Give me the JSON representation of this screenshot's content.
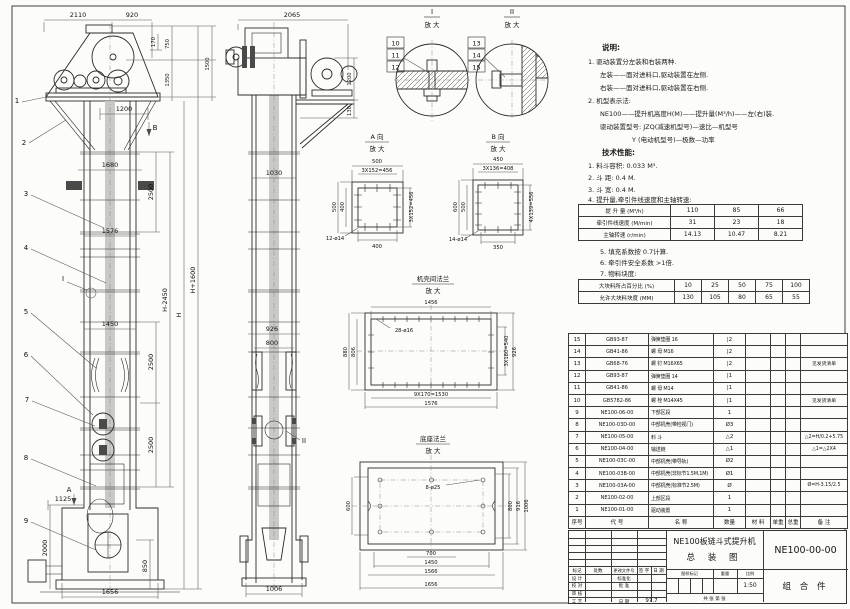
{
  "fv": {
    "callout1": "1",
    "callout2": "2",
    "callout3": "3",
    "callout4": "4",
    "callout5": "5",
    "callout6": "6",
    "callout7": "7",
    "callout8": "8",
    "callout9": "9",
    "detail": "I",
    "view_a_mark": "A",
    "view_b_mark": "B",
    "dims": {
      "top1": "2110",
      "top2": "920",
      "a170": "170",
      "a750": "750",
      "a1350": "1350",
      "a1500": "1500",
      "a1200": "1200",
      "a1680": "1680",
      "a1576": "1576",
      "a1450": "1450",
      "seg1": "2500",
      "seg2": "2500",
      "seg3": "2500",
      "hm": "H-2450",
      "h": "H",
      "hp": "H+1600",
      "a1125": "1125",
      "a2000": "2000",
      "a850": "850",
      "a1656": "1656"
    }
  },
  "sv": {
    "detail": "II",
    "dims": {
      "top": "2065",
      "a1200": "1200",
      "a130": "130",
      "a1030": "1030",
      "a926": "926",
      "a800": "800",
      "a1006": "1006"
    }
  },
  "detail_i": {
    "title": "I",
    "scale": "放 大",
    "c1": "10",
    "c2": "11",
    "c3": "12"
  },
  "detail_ii": {
    "title": "II",
    "scale": "放 大",
    "c1": "13",
    "c2": "14",
    "c3": "15"
  },
  "view_a": {
    "title": "A 向",
    "scale": "放 大",
    "d": {
      "top": "500",
      "top2": "3X152=456",
      "lo": "500",
      "li": "400",
      "r": "3X152=456",
      "b": "400",
      "holes": "12-ø14"
    }
  },
  "view_b": {
    "title": "B 向",
    "scale": "放 大",
    "d": {
      "top": "450",
      "top2": "3X136=408",
      "lo": "600",
      "li": "500",
      "r": "4X139=556",
      "b": "350",
      "holes": "14-ø14"
    }
  },
  "casing_flange": {
    "title": "机壳间法兰",
    "scale": "放 大",
    "d": {
      "top": "1456",
      "holes": "28-ø16",
      "lo": "880",
      "li": "806",
      "ri": "3X180=540",
      "ro": "926",
      "bi": "9X170=1530",
      "bo": "1576"
    }
  },
  "base_flange": {
    "title": "底座法兰",
    "scale": "放 大",
    "d": {
      "holes": "8-ø25",
      "l": "600",
      "r1": "800",
      "r2": "916",
      "r3": "1006",
      "b1": "700",
      "b2": "1450",
      "b3": "1566",
      "b4": "1656"
    }
  },
  "notes": {
    "title": "说明:",
    "l1": "1. 驱动装置分左装和右装两种.",
    "l2": "左装——面对进料口,驱动装置在左侧.",
    "l3": "右装——面对进料口,驱动装置在右侧.",
    "l4": "2. 机型表示法:",
    "l5": "NE100——提升机高度H(M)——提升量(M³/h)——左(右)装.",
    "l6": "驱动装置型号: JZQ(减速机型号)—速比—机型号",
    "l7": "Y (电动机型号)—极数—功率"
  },
  "tech": {
    "title": "技术性能:",
    "l1": "1. 料斗容积: 0.033 M³.",
    "l2": "2. 斗  距: 0.4 M.",
    "l3": "3. 斗  宽: 0.4 M.",
    "l4": "4. 提升量,牵引件线速度和主轴转速:",
    "l5": "5. 填充系数按 0.7计算.",
    "l6": "6. 牵引件安全系数 >1倍.",
    "l7": "7. 物料块度:"
  },
  "perf": {
    "rows": [
      {
        "label": "提 升 量 (M³/h)",
        "v": [
          "110",
          "85",
          "66"
        ]
      },
      {
        "label": "牵引件线速度 (M/min)",
        "v": [
          "31",
          "23",
          "18"
        ]
      },
      {
        "label": "主轴转速 (r/min)",
        "v": [
          "14.13",
          "10.47",
          "8.21"
        ]
      }
    ]
  },
  "lump": {
    "rows": [
      {
        "label": "大块料所占百分比 (%)",
        "v": [
          "10",
          "25",
          "50",
          "75",
          "100"
        ]
      },
      {
        "label": "允许大块料块度 (MM)",
        "v": [
          "130",
          "105",
          "80",
          "65",
          "55"
        ]
      }
    ]
  },
  "bom": {
    "headers": [
      "序号",
      "代  号",
      "名  称",
      "数量",
      "材 料",
      "单重",
      "总重",
      "备  注"
    ],
    "rows": [
      {
        "no": "15",
        "code": "GB93-87",
        "name": "弹簧垫圈  16",
        "qty": "|2",
        "remark": ""
      },
      {
        "no": "14",
        "code": "GB41-86",
        "name": "螺 母  M16",
        "qty": "|2",
        "remark": ""
      },
      {
        "no": "13",
        "code": "GB68-76",
        "name": "螺 钉  M16X65",
        "qty": "|2",
        "remark": "见发货清单"
      },
      {
        "no": "12",
        "code": "GB93-87",
        "name": "弹簧垫圈  14",
        "qty": "|1",
        "remark": ""
      },
      {
        "no": "11",
        "code": "GB41-86",
        "name": "螺 母  M14",
        "qty": "|1",
        "remark": ""
      },
      {
        "no": "10",
        "code": "GB5782-86",
        "name": "螺 栓  M14X45",
        "qty": "|1",
        "remark": "见发货清单"
      },
      {
        "no": "9",
        "code": "NE100-06-00",
        "name": "下部区段",
        "qty": "1",
        "remark": ""
      },
      {
        "no": "8",
        "code": "NE100-03D-00",
        "name": "中部机壳(带检视门)",
        "qty": "Ø3",
        "remark": ""
      },
      {
        "no": "7",
        "code": "NE100-05-00",
        "name": "料 斗",
        "qty": "△2",
        "remark": "△2=H/0.2+5.75"
      },
      {
        "no": "6",
        "code": "NE100-04-00",
        "name": "输送链",
        "qty": "△1",
        "remark": "△1=△2X4"
      },
      {
        "no": "5",
        "code": "NE100-03C-00",
        "name": "中部机壳(带导轨)",
        "qty": "Ø2",
        "remark": ""
      },
      {
        "no": "4",
        "code": "NE100-03B-00",
        "name": "中部机壳(非标节1.5M,1M)",
        "qty": "Ø1",
        "remark": ""
      },
      {
        "no": "3",
        "code": "NE100-03A-00",
        "name": "中部机壳(标准节2.5M)",
        "qty": "Ø",
        "remark": "Ø=H-3.15/2.5"
      },
      {
        "no": "2",
        "code": "NE100-02-00",
        "name": "上部区段",
        "qty": "1",
        "remark": ""
      },
      {
        "no": "1",
        "code": "NE100-01-00",
        "name": "驱动装置",
        "qty": "1",
        "remark": ""
      }
    ]
  },
  "title_block": {
    "rev1": "标记",
    "rev2": "处数",
    "rev3": "更改文件号",
    "rev4": "签 字",
    "rev5": "日 期",
    "row1a": "设 计",
    "row1b": "标准化",
    "row2a": "校 对",
    "row2b": "批 准",
    "row3a": "审 核",
    "row3b": "",
    "row4a": "工 艺",
    "row4b": "日 期",
    "date": "97.7",
    "title1": "NE100板链斗式提升机",
    "title2": "总  装  图",
    "stamp1": "图样标记",
    "stamp2": "重量",
    "stamp3": "比例",
    "scale": "1:50",
    "sheets": "共   张   第   张",
    "dwg_no": "NE100-00-00",
    "item_type": "组 合 件"
  }
}
